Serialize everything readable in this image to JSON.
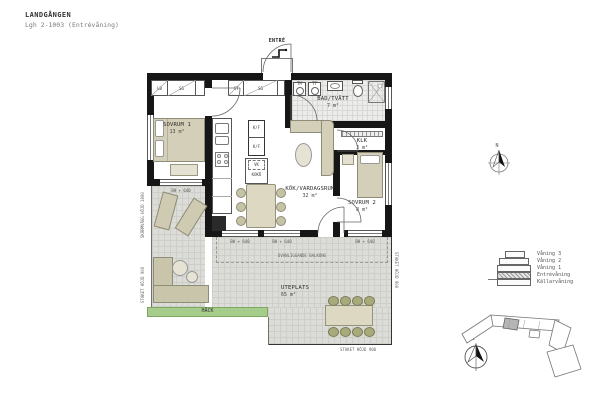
{
  "header": {
    "project": "LANDGÅNGEN",
    "apartment": "Lgh 2-1003 (Entrévåning)"
  },
  "plan": {
    "entrance": {
      "label": "ENTRÉ"
    },
    "rooms": {
      "sovrum1": {
        "name": "SOVRUM 1",
        "area": "13 m²"
      },
      "badtvatt": {
        "name": "BAD/TVÄTT",
        "area": "7 m²"
      },
      "klk": {
        "name": "KLK",
        "area": "3 m²"
      },
      "sovrum2": {
        "name": "SOVRUM 2",
        "area": "8 m²"
      },
      "kokvardagsrum": {
        "name": "KÖK/VARDAGSRUM",
        "area": "32 m²"
      },
      "uteplats": {
        "name": "UTEPLATS",
        "area": "65 m²"
      }
    },
    "closets": {
      "lb": "LB",
      "sg_left": "SG",
      "sti": "ST",
      "sg_hall": "SG"
    },
    "appliances": {
      "tm": "TM",
      "tt": "TT",
      "kf_upper": "K/F",
      "kf_lower": "K/F",
      "vk": "VK",
      "koko": "KOKÖ"
    },
    "window_sill_label": "BH + 640",
    "annotations": {
      "balcony_above": "OVANLIGGANDE BALKONG",
      "hedge": "HÄCK",
      "screen_left": "SKÄRMVÄGG HÖJD 1800",
      "fence_left": "STAKET HÖJD 900",
      "fence_right": "STAKET HÖJD 900",
      "fence_bottom": "STAKET HÖJD 900"
    }
  },
  "legend": {
    "north_label": "N",
    "floors": [
      "Våning 3",
      "Våning 2",
      "Våning 1",
      "Entrévåning",
      "Källarvåning"
    ],
    "highlighted_floor": "Entrévåning"
  },
  "colors": {
    "wall": "#161616",
    "furniture": "#d3cfb8",
    "outdoor_tile": "#dcdcd8",
    "hedge": "#a6cc8b",
    "floor_highlight_hatch": "#9a9a9a"
  }
}
